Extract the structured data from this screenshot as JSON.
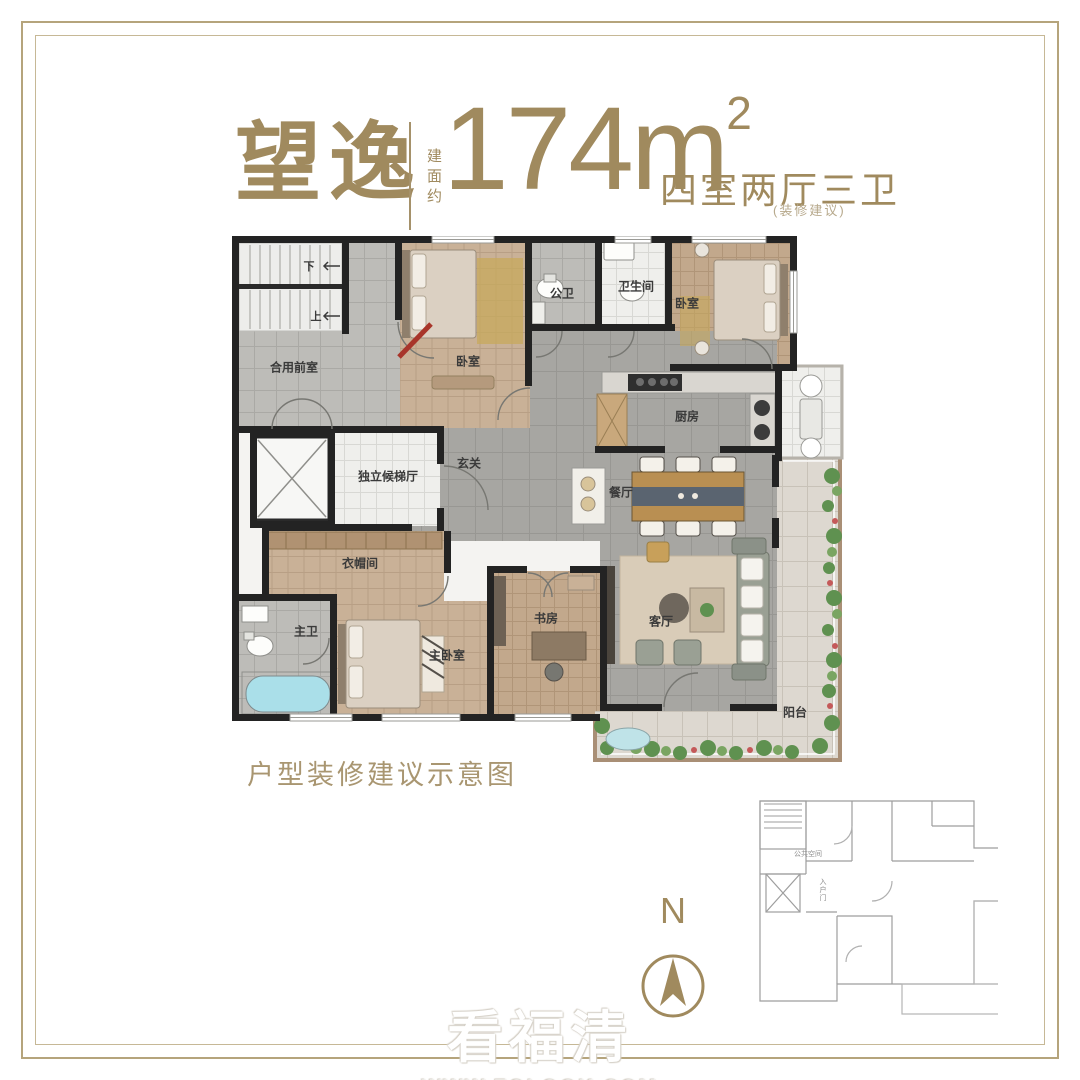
{
  "header": {
    "title": "望逸",
    "area_prefix": "建面约",
    "area_value": "174",
    "area_unit": "m",
    "area_sup": "2",
    "layout_text": "四室两厅三卫",
    "note": "(装修建议)"
  },
  "floorplan": {
    "rooms": {
      "stair_down": "下",
      "stair_up": "上",
      "shared_front_room": "合用前室",
      "bedroom_top_left": "卧室",
      "public_bathroom": "公卫",
      "bathroom": "卫生间",
      "bedroom_top_right": "卧室",
      "kitchen": "厨房",
      "elevator_hall": "独立候梯厅",
      "foyer": "玄关",
      "dining_room": "餐厅",
      "cloakroom": "衣帽间",
      "master_bathroom": "主卫",
      "master_bedroom": "主卧室",
      "study": "书房",
      "living_room": "客厅",
      "balcony": "阳台"
    }
  },
  "caption": "户型装修建议示意图",
  "compass": {
    "north_label": "N"
  },
  "mini_plan": {
    "public_space": "公共空间",
    "entry_door": "入户门"
  },
  "watermark": {
    "line1": "看福清",
    "line2": "WWW.FQLOOK.COM"
  },
  "colors": {
    "brand_gold": "#a08a5e",
    "frame_gold": "#b5a47c",
    "wall_black": "#232323",
    "wood_floor": "#c9b197",
    "tile_gray": "#bdbcb8",
    "floor_gray": "#a7a6a2",
    "balcony_frame": "#a98f76",
    "plant_green": "#5f9150",
    "tub_blue": "#aadfe9",
    "entry_door_red": "#a8352a"
  }
}
